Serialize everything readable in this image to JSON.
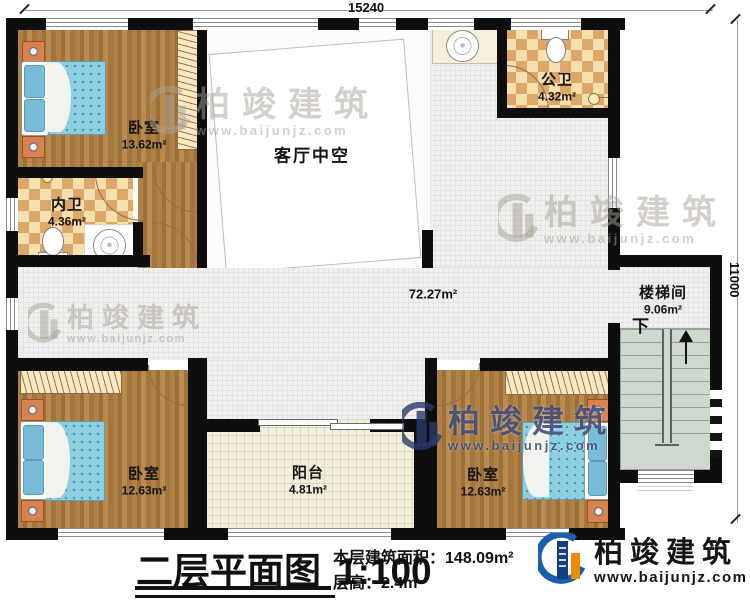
{
  "dimensions": {
    "width_top": "15240",
    "height_right": "11000"
  },
  "rooms": {
    "bedroom_tl": {
      "name": "卧室",
      "area": "13.62m²"
    },
    "inner_bath": {
      "name": "内卫",
      "area": "4.36m²"
    },
    "living_void": {
      "name": "客厅中空"
    },
    "public_bath": {
      "name": "公卫",
      "area": "4.32m²"
    },
    "hallway": {
      "area": "72.27m²"
    },
    "stairwell": {
      "name": "楼梯间",
      "area": "9.06m²",
      "direction": "下"
    },
    "bedroom_bl": {
      "name": "卧室",
      "area": "12.63m²"
    },
    "balcony": {
      "name": "阳台",
      "area": "4.81m²"
    },
    "bedroom_br": {
      "name": "卧室",
      "area": "12.63m²"
    }
  },
  "footer": {
    "title": "二层平面图",
    "scale": "1:100",
    "area_label": "本层建筑面积：",
    "area_value": "148.09m²",
    "floor_height_label": "层高：",
    "floor_height_value": "2.4m"
  },
  "brand": {
    "name": "柏竣建筑",
    "website": "www.baijunjz.com"
  },
  "watermark": {
    "name": "柏竣建筑",
    "website": "www.baijunjz.com"
  },
  "colors": {
    "brand_blue": "#1a5fa8",
    "brand_orange": "#ee8c0a",
    "wall": "#0e0e0e",
    "bed": "#86cde0"
  }
}
